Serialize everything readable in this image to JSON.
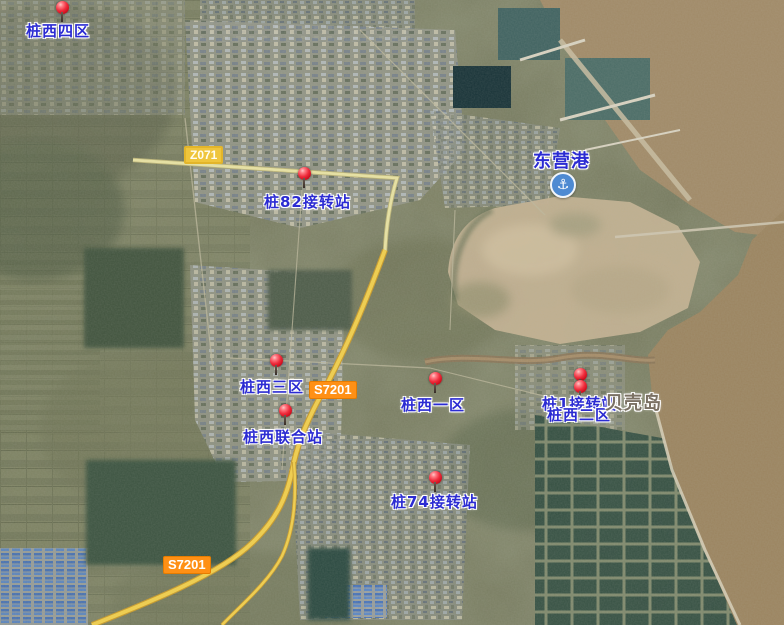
{
  "app": {
    "view": "satellite-map"
  },
  "map": {
    "markers": [
      {
        "id": "zhuangxi-siqu",
        "label": "桩西四区",
        "pin": {
          "x": 62,
          "y": 7
        },
        "label_pos": {
          "x": 26,
          "y": 20
        }
      },
      {
        "id": "zhuang82-station",
        "label": "桩82接转站",
        "pin": {
          "x": 304,
          "y": 173
        },
        "label_pos": {
          "x": 264,
          "y": 191
        }
      },
      {
        "id": "zhuangxi-sanqu",
        "label": "桩西三区",
        "pin": {
          "x": 276,
          "y": 360
        },
        "label_pos": {
          "x": 240,
          "y": 376
        }
      },
      {
        "id": "zhuangxi-yiqu",
        "label": "桩西一区",
        "pin": {
          "x": 435,
          "y": 378
        },
        "label_pos": {
          "x": 401,
          "y": 394
        }
      },
      {
        "id": "zhuang1-station",
        "label": "桩1接转站",
        "pin": {
          "x": 580,
          "y": 374
        },
        "label_pos": {
          "x": 542,
          "y": 393
        }
      },
      {
        "id": "zhuangxi-erqu",
        "label": "桩西二区",
        "pin": {
          "x": 580,
          "y": 386
        },
        "label_pos": {
          "x": 547,
          "y": 404
        }
      },
      {
        "id": "zhuangxi-lianhezhan",
        "label": "桩西联合站",
        "pin": {
          "x": 285,
          "y": 410
        },
        "label_pos": {
          "x": 243,
          "y": 426
        }
      },
      {
        "id": "zhuang74-station",
        "label": "桩74接转站",
        "pin": {
          "x": 435,
          "y": 477
        },
        "label_pos": {
          "x": 391,
          "y": 491
        }
      }
    ],
    "place_labels": [
      {
        "id": "dongying-port",
        "text": "东营港",
        "x": 533,
        "y": 147,
        "color": "blue",
        "icon": "anchor",
        "icon_x": 550,
        "icon_y": 172
      },
      {
        "id": "shell-island",
        "text": "贝壳岛",
        "x": 605,
        "y": 389,
        "color": "gray"
      }
    ],
    "road_labels": [
      {
        "id": "z071",
        "text": "Z071",
        "x": 184,
        "y": 146,
        "style": "yellow"
      },
      {
        "id": "s7201-mid",
        "text": "S7201",
        "x": 309,
        "y": 381,
        "style": "orange"
      },
      {
        "id": "s7201-sw",
        "text": "S7201",
        "x": 163,
        "y": 556,
        "style": "orange"
      }
    ],
    "icons": {
      "anchor": "⚓"
    },
    "colors": {
      "label_blue": "#2b2bd2",
      "label_gray": "#7b7164",
      "badge_orange": "#ff9015",
      "badge_yellow": "#efc53c",
      "road_highlight": "#f2cf4a",
      "road_minor": "#e9e3a2",
      "pin_red": "#ef2c3c"
    }
  }
}
